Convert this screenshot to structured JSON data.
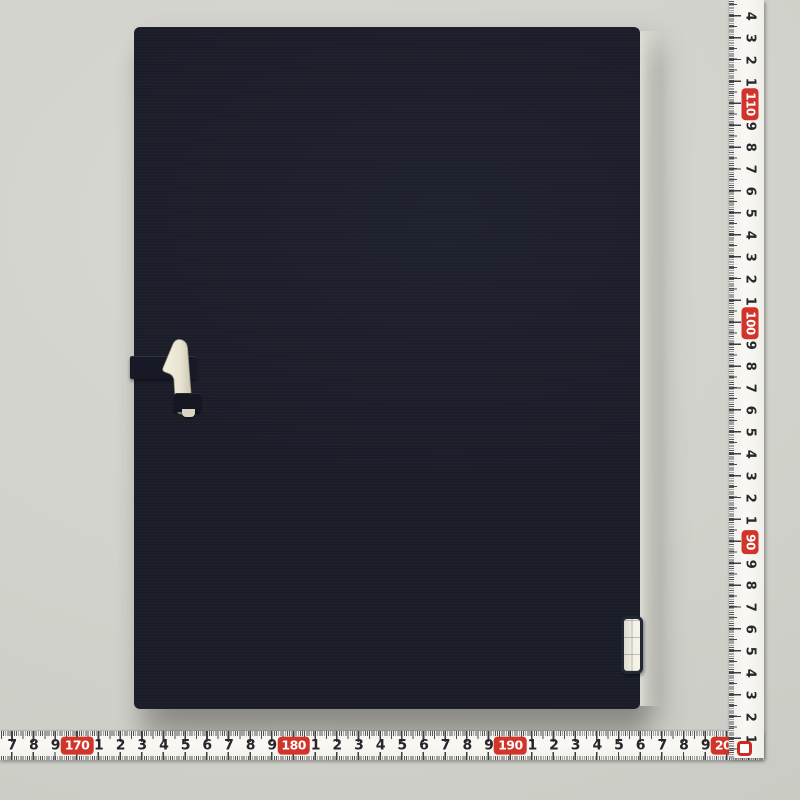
{
  "scene": {
    "subject": "dark navy fabric certificate folder (back cover) with ivory bone clasp, photographed on grey surface with two tape measures"
  },
  "colors": {
    "background": "#cfd0c9",
    "folder": "#1a1c28",
    "tape_white": "#f6f5f0",
    "red_accent": "#d1342b",
    "tick": "#3c3c42",
    "clasp_ivory": "#ece7d5"
  },
  "rulers": {
    "horizontal": {
      "unit": "cm",
      "direction": "values increase left to right",
      "labels": [
        "7",
        "8",
        "9",
        "170",
        "1",
        "2",
        "3",
        "4",
        "5",
        "6",
        "7",
        "8",
        "9",
        "180",
        "1",
        "2",
        "3",
        "4",
        "5",
        "6",
        "7",
        "8",
        "9",
        "190",
        "1",
        "2",
        "3",
        "4",
        "5",
        "6",
        "7",
        "8",
        "9",
        "200"
      ],
      "red_labels": [
        "170",
        "180",
        "190",
        "200"
      ]
    },
    "vertical": {
      "unit": "cm",
      "direction": "values decrease top to bottom",
      "labels": [
        "4",
        "3",
        "2",
        "1",
        "110",
        "9",
        "8",
        "7",
        "6",
        "5",
        "4",
        "3",
        "2",
        "1",
        "100",
        "9",
        "8",
        "7",
        "6",
        "5",
        "4",
        "3",
        "2",
        "1",
        "90",
        "9",
        "8",
        "7",
        "6",
        "5",
        "4",
        "3",
        "2",
        "1"
      ],
      "red_labels": [
        "110",
        "100",
        "90"
      ],
      "end_marker": "0"
    }
  }
}
